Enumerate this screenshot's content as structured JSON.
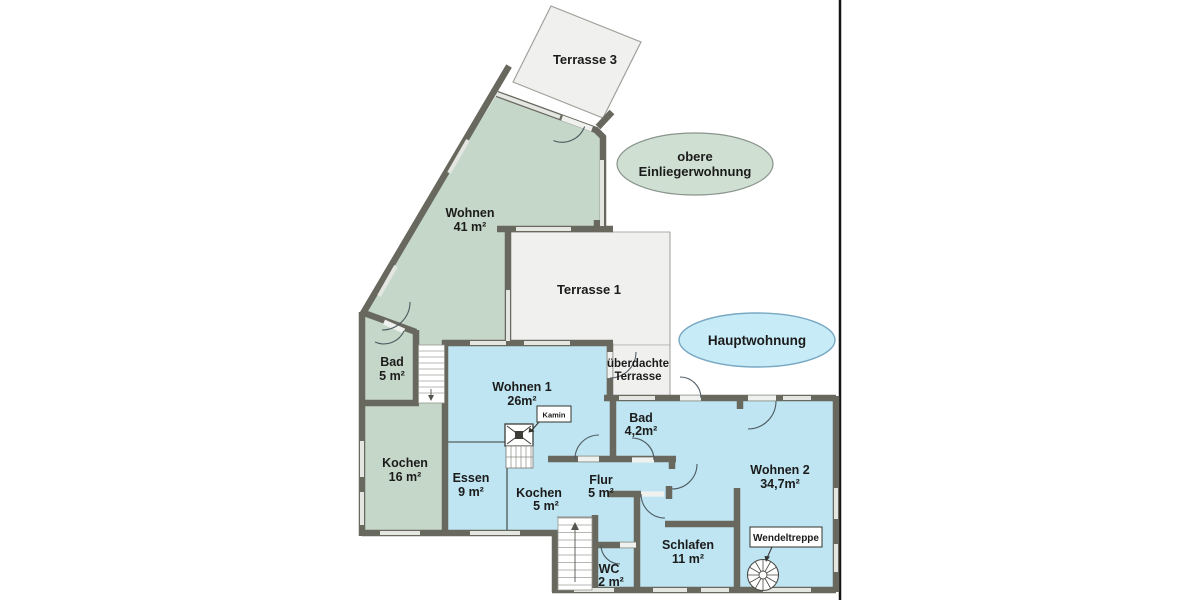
{
  "rooms": {
    "terrasse3": {
      "label": "Terrasse 3"
    },
    "wohnen_og": {
      "name": "Wohnen",
      "area": "41 m²"
    },
    "bad_og": {
      "name": "Bad",
      "area": "5 m²"
    },
    "kochen_og": {
      "name": "Kochen",
      "area": "16 m²"
    },
    "terrasse1": {
      "label": "Terrasse 1"
    },
    "ueberdachte_terrasse": {
      "name_line1": "überdachte",
      "name_line2": "Terrasse"
    },
    "wohnen1": {
      "name": "Wohnen 1",
      "area": "26m²"
    },
    "essen": {
      "name": "Essen",
      "area": "9 m²"
    },
    "kochen_eg": {
      "name": "Kochen",
      "area": "5 m²"
    },
    "flur": {
      "name": "Flur",
      "area": "5 m²"
    },
    "bad_eg": {
      "name": "Bad",
      "area": "4,2m²"
    },
    "wohnen2": {
      "name": "Wohnen 2",
      "area": "34,7m²"
    },
    "schlafen": {
      "name": "Schlafen",
      "area": "11 m²"
    },
    "wc": {
      "name": "WC",
      "area": "2 m²"
    }
  },
  "annotations": {
    "kamin": {
      "label": "Kamin"
    },
    "wendeltreppe": {
      "label": "Wendeltreppe"
    },
    "upper_unit_badge": {
      "line1": "obere",
      "line2": "Einliegerwohnung"
    },
    "main_unit_badge": {
      "label": "Hauptwohnung"
    }
  },
  "colors": {
    "upper_fill": "#c5d7c8",
    "main_fill": "#bee5f1",
    "terrace_fill": "#f0f0ee",
    "wall": "#68685f",
    "upper_badge_fill": "#cfe0d3",
    "main_badge_fill": "#c7ebf7",
    "text": "#1b1b1b"
  }
}
